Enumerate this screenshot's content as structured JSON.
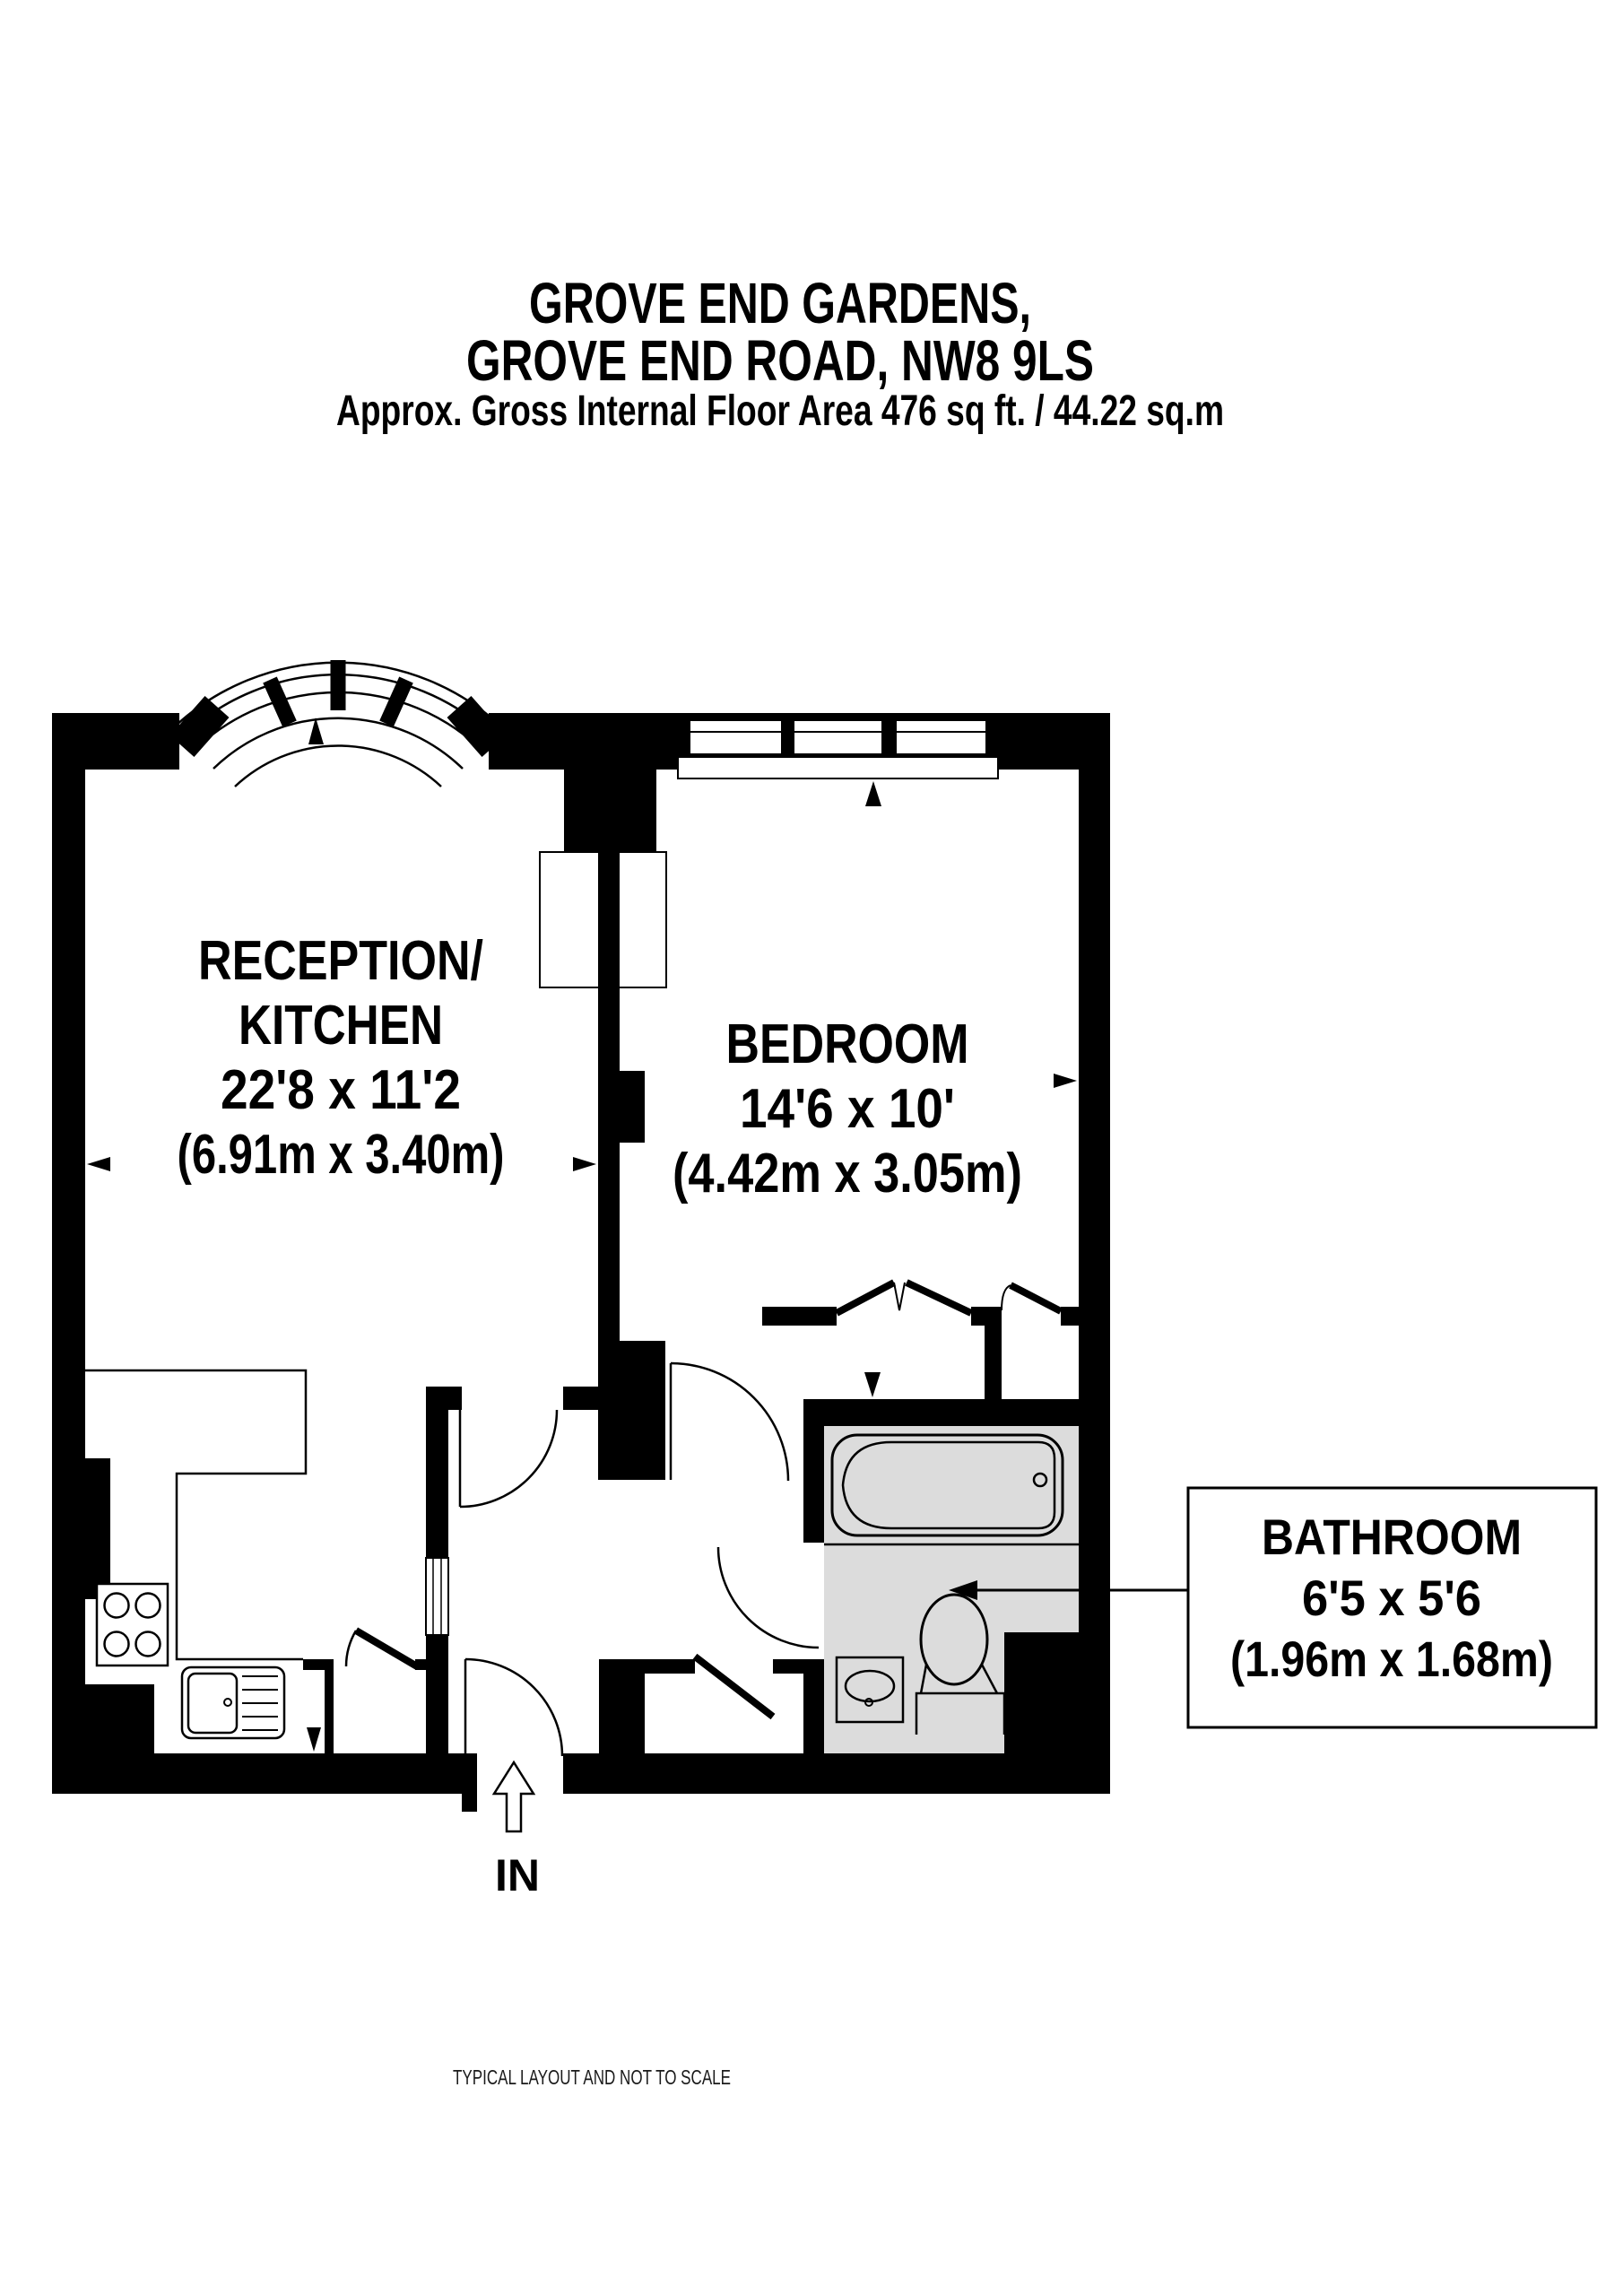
{
  "title": {
    "line1": "GROVE END GARDENS,",
    "line2": "GROVE END ROAD, NW8 9LS",
    "line3": "Approx. Gross Internal Floor Area 476 sq ft. / 44.22 sq.m"
  },
  "rooms": {
    "reception": {
      "label_line1": "RECEPTION/",
      "label_line2": "KITCHEN",
      "dims_imperial": "22'8 x 11'2",
      "dims_metric": "(6.91m x 3.40m)"
    },
    "bedroom": {
      "label": "BEDROOM",
      "dims_imperial": "14'6 x 10'",
      "dims_metric": "(4.42m x 3.05m)"
    },
    "bathroom": {
      "label": "BATHROOM",
      "dims_imperial": "6'5 x 5'6",
      "dims_metric": "(1.96m x 1.68m)"
    }
  },
  "entry_label": "IN",
  "footer": "TYPICAL LAYOUT AND NOT TO SCALE",
  "colors": {
    "wall": "#000000",
    "bathroom_floor": "#dcdcdc",
    "background": "#ffffff",
    "footer_text": "#1a1a1a"
  }
}
